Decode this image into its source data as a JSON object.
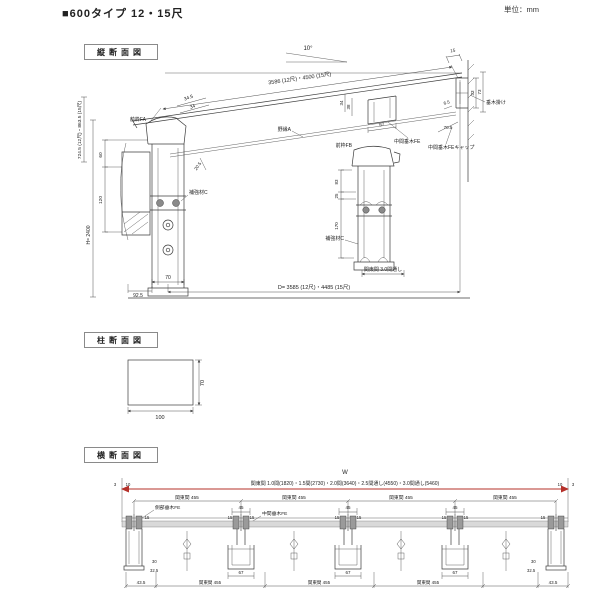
{
  "header": {
    "title": "■600タイプ 12・15尺",
    "unit": "単位：mm"
  },
  "section_labels": {
    "vertical": "縦断面図",
    "column": "柱断面図",
    "cross": "横断面図"
  },
  "vertical": {
    "angle": "10°",
    "slope_dim": "3586 (12尺)・4500 (15尺)",
    "depth_dim": "D= 3585 (12尺)・4485 (15尺)",
    "left_height": "724.5 (12尺)・863.5 (15尺)",
    "total_height": "H= 2400",
    "dims": {
      "d34_5": "34.5",
      "d34": "34",
      "d60": "60",
      "d120": "120",
      "d20_5": "20.5",
      "d92_5": "92.5",
      "d70": "70",
      "d83": "83",
      "d25": "25",
      "d170": "170",
      "d67": "67",
      "d15": "15",
      "d33": "33",
      "d73": "73",
      "d6_5": "6.5",
      "d70_5": "70.5",
      "d38": "38"
    },
    "labels": {
      "front_frame_a": "前枠FA",
      "front_frame_b": "前枠FB",
      "reinforce": "補強材C",
      "joist": "野縁A",
      "mid_rafter": "中間垂木FE",
      "mid_rafter_cap": "中間垂木FEキャップ",
      "rafter_hook": "垂木掛け",
      "span_note": "関東間 3.0間通し"
    }
  },
  "column": {
    "width": "100",
    "height": "70"
  },
  "cross": {
    "w": "W",
    "span_text": "関東間 1.0間(1820)・1.5間(2730)・2.0間(3640)・2.5間通し(4550)・3.0間通し(5460)",
    "d3": "3",
    "d10": "10",
    "kanto455": "関東間 455",
    "d45": "45",
    "d15": "15",
    "side_rafter": "側部垂木FE",
    "mid_rafter": "中間垂木FE",
    "d30": "30",
    "d32_5": "32.5",
    "d43_5": "43.5",
    "d67": "67"
  },
  "colors": {
    "accent": "#b5302a",
    "line": "#3c3c3c"
  }
}
